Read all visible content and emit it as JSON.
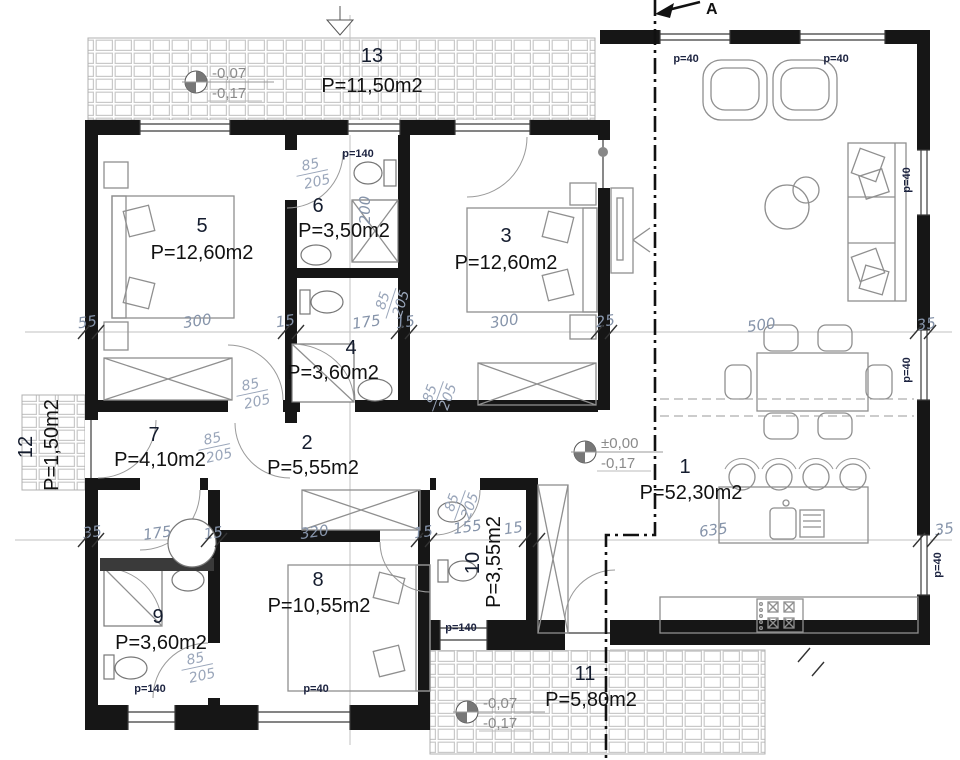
{
  "rooms": {
    "r1": {
      "num": "1",
      "area": "P=52,30m2"
    },
    "r2": {
      "num": "2",
      "area": "P=5,55m2"
    },
    "r3": {
      "num": "3",
      "area": "P=12,60m2"
    },
    "r4": {
      "num": "4",
      "area": "P=3,60m2"
    },
    "r5": {
      "num": "5",
      "area": "P=12,60m2"
    },
    "r6": {
      "num": "6",
      "area": "P=3,50m2"
    },
    "r7": {
      "num": "7",
      "area": "P=4,10m2"
    },
    "r8": {
      "num": "8",
      "area": "P=10,55m2"
    },
    "r9": {
      "num": "9",
      "area": "P=3,60m2"
    },
    "r10": {
      "num": "10",
      "area": "P=3,55m2"
    },
    "r11": {
      "num": "11",
      "area": "P=5,80m2"
    },
    "r12": {
      "num": "12",
      "area": "P=1,50m2"
    },
    "r13": {
      "num": "13",
      "area": "P=11,50m2"
    }
  },
  "levels": [
    {
      "top": "-0,07",
      "bottom": "-0,17"
    },
    {
      "top": "±0,00",
      "bottom": "-0,17"
    },
    {
      "top": "-0,07",
      "bottom": "-0,17"
    }
  ],
  "parapets": [
    "p=140",
    "p=40",
    "p=40",
    "p=40",
    "p=40",
    "p=40",
    "p=140",
    "p=40",
    "p=140"
  ],
  "dims": [
    "55",
    "300",
    "15",
    "175",
    "15",
    "300",
    "25",
    "500",
    "35",
    "200",
    "35",
    "175",
    "15",
    "320",
    "15",
    "155",
    "15",
    "635",
    "35"
  ],
  "door_size": {
    "width": "85",
    "height": "205"
  },
  "section": {
    "label": "A"
  },
  "colors": {
    "wall": "#161616",
    "dim_text": "#8694aa",
    "parapet_text": "#1c2340",
    "hatch": "#c9c9c9"
  }
}
